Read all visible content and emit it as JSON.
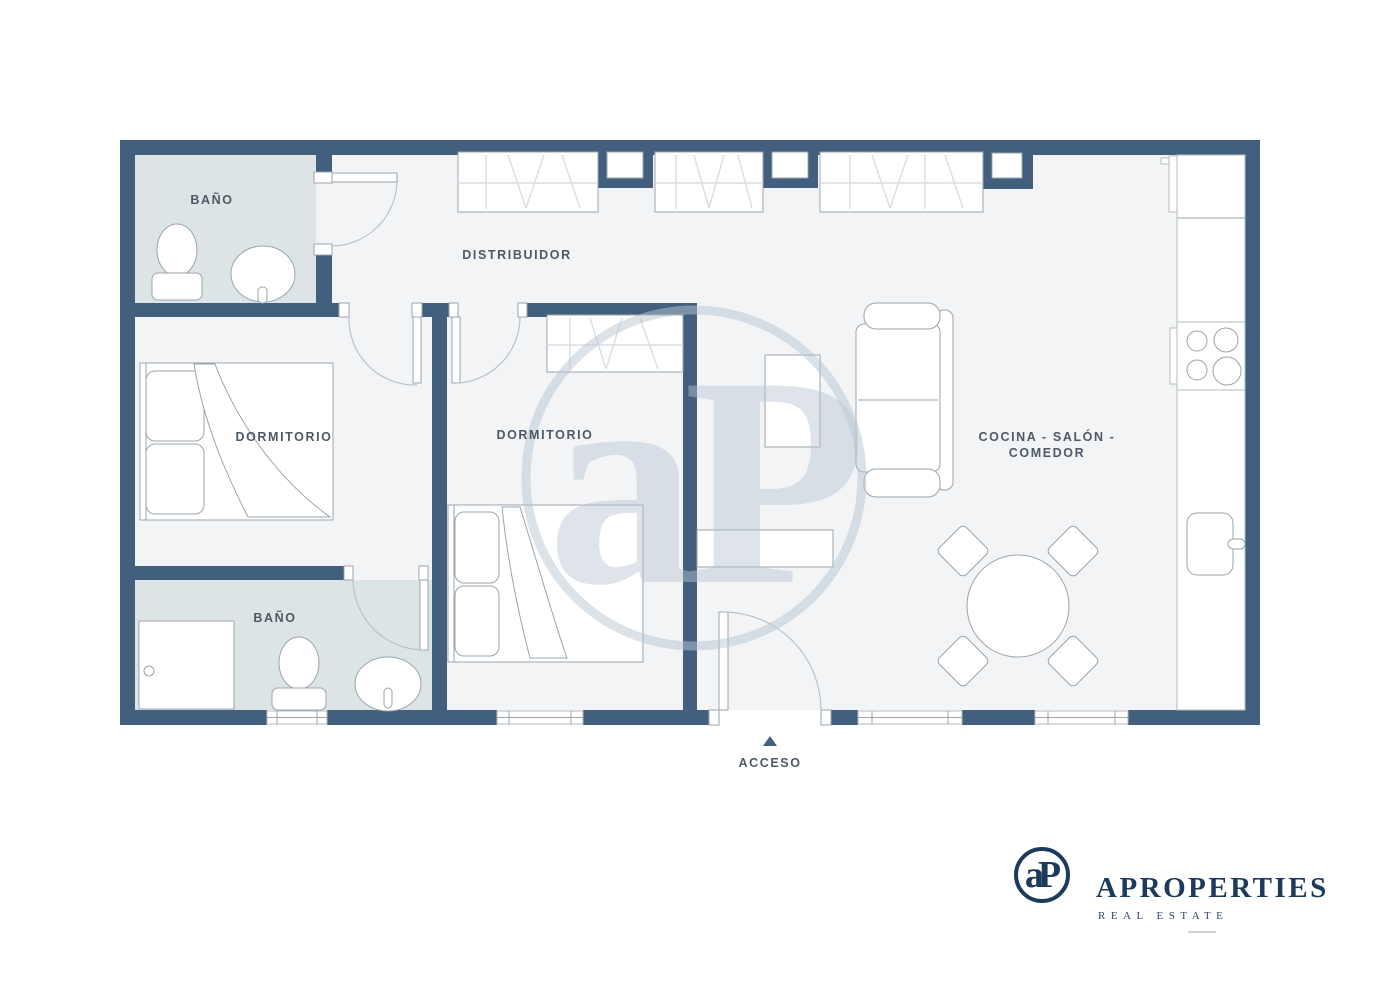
{
  "theme": {
    "wall_color": "#42607d",
    "bath_floor_color": "#dde4e6",
    "floor_color": "#f3f4f6",
    "outline_color": "#9aa4ad",
    "hatch_color": "#d9dee3",
    "arc_color": "#bac2c9",
    "brand_navy": "#1c3a5c",
    "label_color": "#4d5965",
    "watermark_color": "#b7c5d1"
  },
  "floorplan": {
    "rooms": [
      {
        "id": "bano-top",
        "label": "BAÑO"
      },
      {
        "id": "distribuidor",
        "label": "DISTRIBUIDOR"
      },
      {
        "id": "dormitorio-left",
        "label": "DORMITORIO"
      },
      {
        "id": "dormitorio-center",
        "label": "DORMITORIO"
      },
      {
        "id": "bano-bottom",
        "label": "BAÑO"
      },
      {
        "id": "cocina-salon-comedor",
        "label": "COCINA - SALÓN -",
        "label_line2": "COMEDOR"
      }
    ],
    "entrance": {
      "label": "ACCESO"
    }
  },
  "branding": {
    "monogram": "aP",
    "name": "APROPERTIES",
    "tagline": "REAL ESTATE"
  },
  "watermark": {
    "monogram": "aP"
  }
}
